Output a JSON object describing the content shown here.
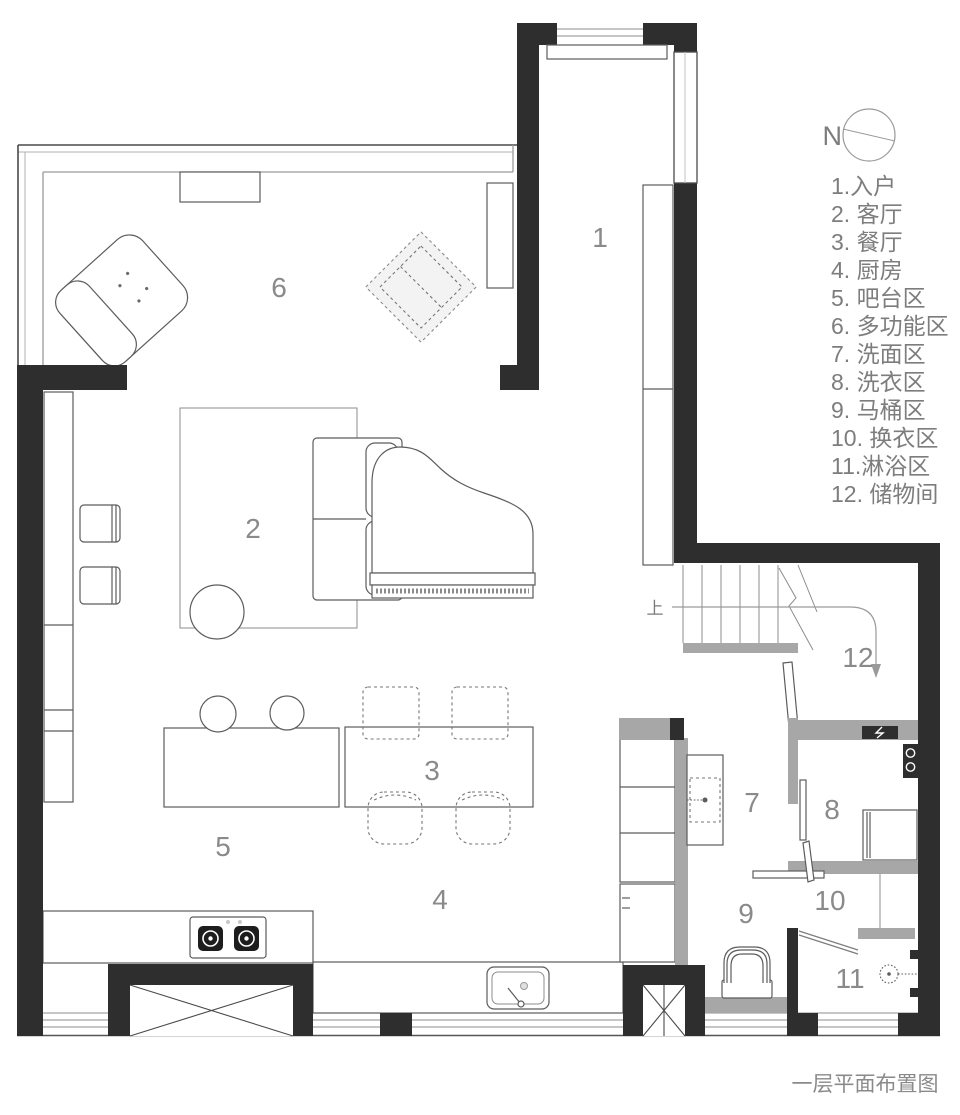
{
  "title": "一层平面布置图",
  "compass": {
    "label": "N"
  },
  "stairs": {
    "up_label": "上"
  },
  "colors": {
    "wall_black": "#2e2e2e",
    "wall_gray": "#a7a7a7",
    "furniture_outline": "#5c5c5c",
    "legend_text": "#7d7d7d",
    "room_label_text": "#8a8a8a"
  },
  "legend": {
    "items": [
      "1.入户",
      "2. 客厅",
      "3. 餐厅",
      "4. 厨房",
      "5. 吧台区",
      "6. 多功能区",
      "7. 洗面区",
      "8. 洗衣区",
      "9. 马桶区",
      "10. 换衣区",
      "11.淋浴区",
      "12. 储物间"
    ]
  },
  "rooms": [
    {
      "number": "1",
      "name": "入户"
    },
    {
      "number": "2",
      "name": "客厅"
    },
    {
      "number": "3",
      "name": "餐厅"
    },
    {
      "number": "4",
      "name": "厨房"
    },
    {
      "number": "5",
      "name": "吧台区"
    },
    {
      "number": "6",
      "name": "多功能区"
    },
    {
      "number": "7",
      "name": "洗面区"
    },
    {
      "number": "8",
      "name": "洗衣区"
    },
    {
      "number": "9",
      "name": "马桶区"
    },
    {
      "number": "10",
      "name": "换衣区"
    },
    {
      "number": "11",
      "name": "淋浴区"
    },
    {
      "number": "12",
      "name": "储物间"
    }
  ]
}
